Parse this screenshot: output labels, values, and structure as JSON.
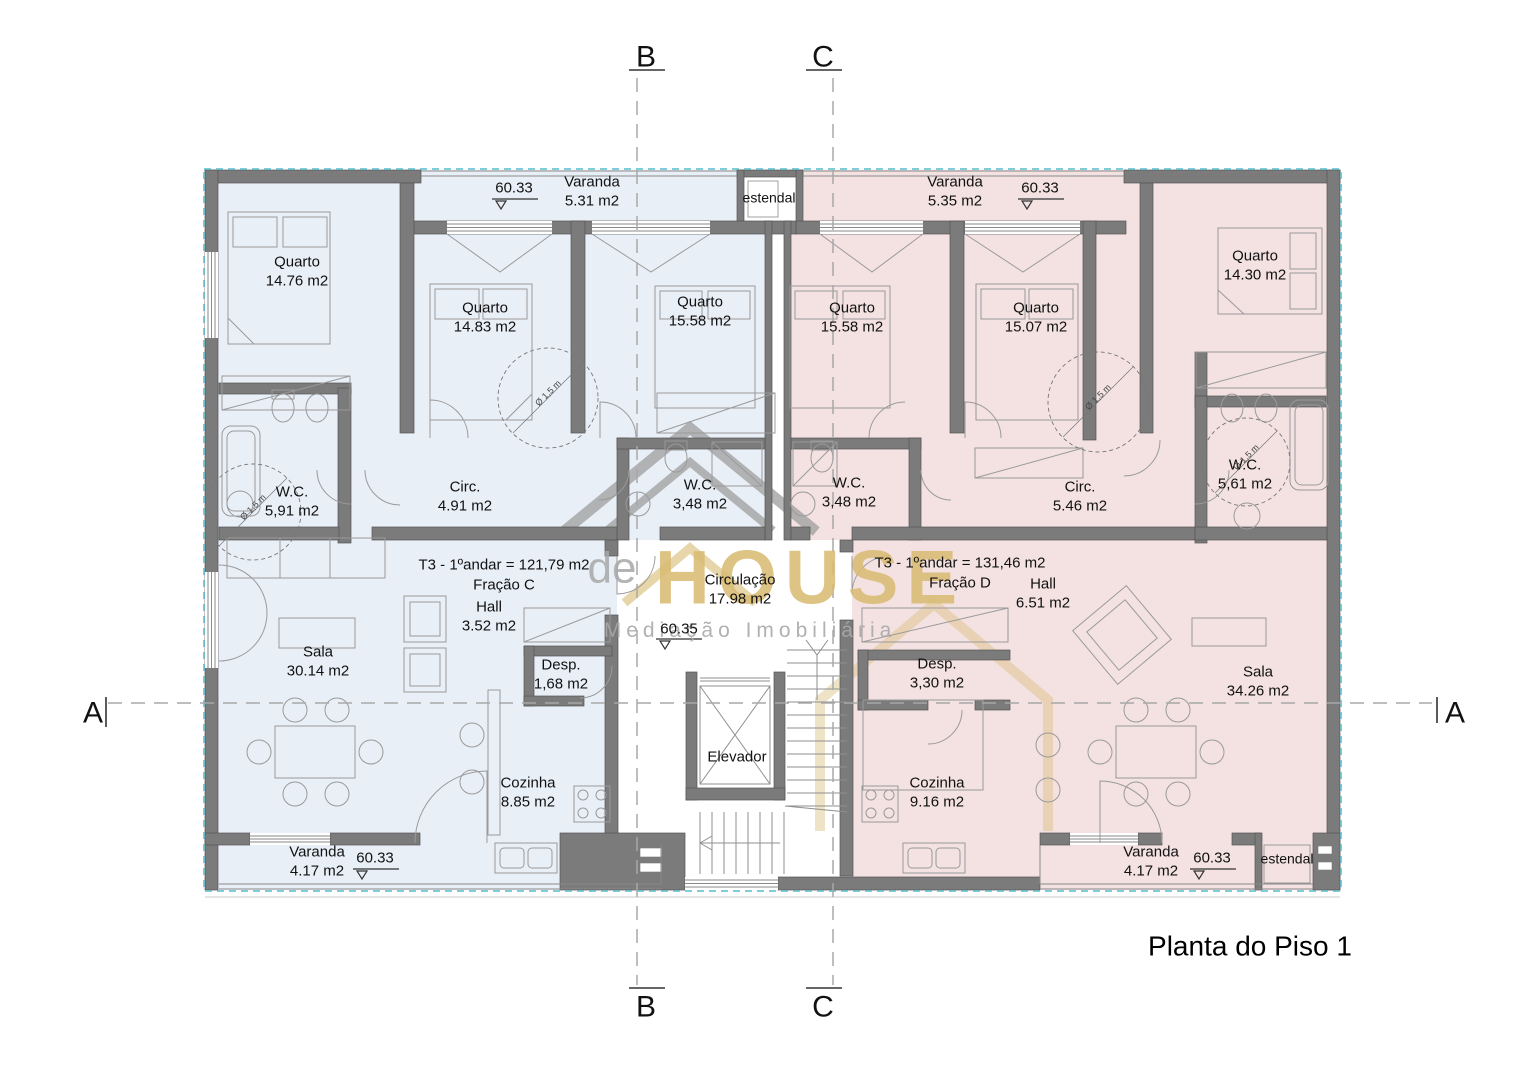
{
  "title": "Planta do Piso 1",
  "watermark": {
    "prefix": "de",
    "brand": "HOUSE",
    "tagline": "Mediação Imobiliária"
  },
  "markers": {
    "a": "A",
    "b": "B",
    "c": "C"
  },
  "levels": {
    "varanda_top_left": "60.33",
    "varanda_top_right": "60.33",
    "varanda_bottom_left": "60.33",
    "varanda_bottom_right": "60.33",
    "circulation": "60.35"
  },
  "turning_label": "Ø 1,5 m",
  "common": {
    "circulation_name": "Circulação",
    "circulation_area": "17.98 m2",
    "elevator": "Elevador",
    "estendal_top": "estendal",
    "estendal_bottom": "estendal"
  },
  "unit_c": {
    "summary": "T3 - 1ºandar = 121,79 m2",
    "fraction": "Fração C",
    "rooms": [
      {
        "name": "Quarto",
        "area": "14.76 m2"
      },
      {
        "name": "Quarto",
        "area": "14.83 m2"
      },
      {
        "name": "Quarto",
        "area": "15.58 m2"
      },
      {
        "name": "Varanda",
        "area": "5.31 m2"
      },
      {
        "name": "W.C.",
        "area": "5,91 m2"
      },
      {
        "name": "Circ.",
        "area": "4.91 m2"
      },
      {
        "name": "W.C.",
        "area": "3,48 m2"
      },
      {
        "name": "Hall",
        "area": "3.52 m2"
      },
      {
        "name": "Desp.",
        "area": "1,68 m2"
      },
      {
        "name": "Sala",
        "area": "30.14 m2"
      },
      {
        "name": "Cozinha",
        "area": "8.85 m2"
      },
      {
        "name": "Varanda",
        "area": "4.17 m2"
      }
    ]
  },
  "unit_d": {
    "summary": "T3 - 1ºandar = 131,46 m2",
    "fraction": "Fração D",
    "rooms": [
      {
        "name": "Quarto",
        "area": "15.58 m2"
      },
      {
        "name": "Quarto",
        "area": "15.07 m2"
      },
      {
        "name": "Quarto",
        "area": "14.30 m2"
      },
      {
        "name": "Varanda",
        "area": "5.35 m2"
      },
      {
        "name": "W.C.",
        "area": "3,48 m2"
      },
      {
        "name": "Circ.",
        "area": "5.46 m2"
      },
      {
        "name": "W.C.",
        "area": "5,61 m2"
      },
      {
        "name": "Hall",
        "area": "6.51 m2"
      },
      {
        "name": "Desp.",
        "area": "3,30 m2"
      },
      {
        "name": "Cozinha",
        "area": "9.16 m2"
      },
      {
        "name": "Sala",
        "area": "34.26 m2"
      },
      {
        "name": "Varanda",
        "area": "4.17 m2"
      }
    ]
  },
  "palette": {
    "unit_c_fill": "#e9eff7",
    "unit_d_fill": "#f3e2e1",
    "wall": "#7b7b7b",
    "insulation": "#5fc0d0",
    "gold": "#d7ba72"
  }
}
